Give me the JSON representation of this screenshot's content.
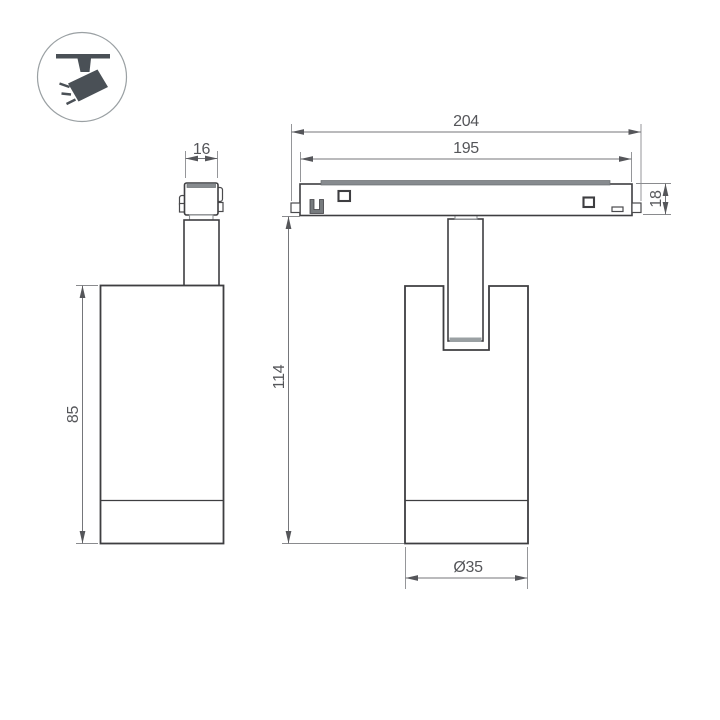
{
  "drawing": {
    "title": "magnetic-track-spotlight-dimension-drawing",
    "dimensions": {
      "adapter_width": "16",
      "body_height": "85",
      "track_length_outer": "204",
      "track_length_inner": "195",
      "track_height": "18",
      "overall_height": "114",
      "body_diameter": "Ø35"
    },
    "icons": {
      "spotlight": "track-spotlight-icon"
    },
    "colors": {
      "object_line": "#3e3e41",
      "dimension_line": "#75767a",
      "dimension_text": "#55565a",
      "icon_fill": "#4a5056",
      "gray_detail": "#878b8f",
      "background": "#ffffff"
    }
  }
}
